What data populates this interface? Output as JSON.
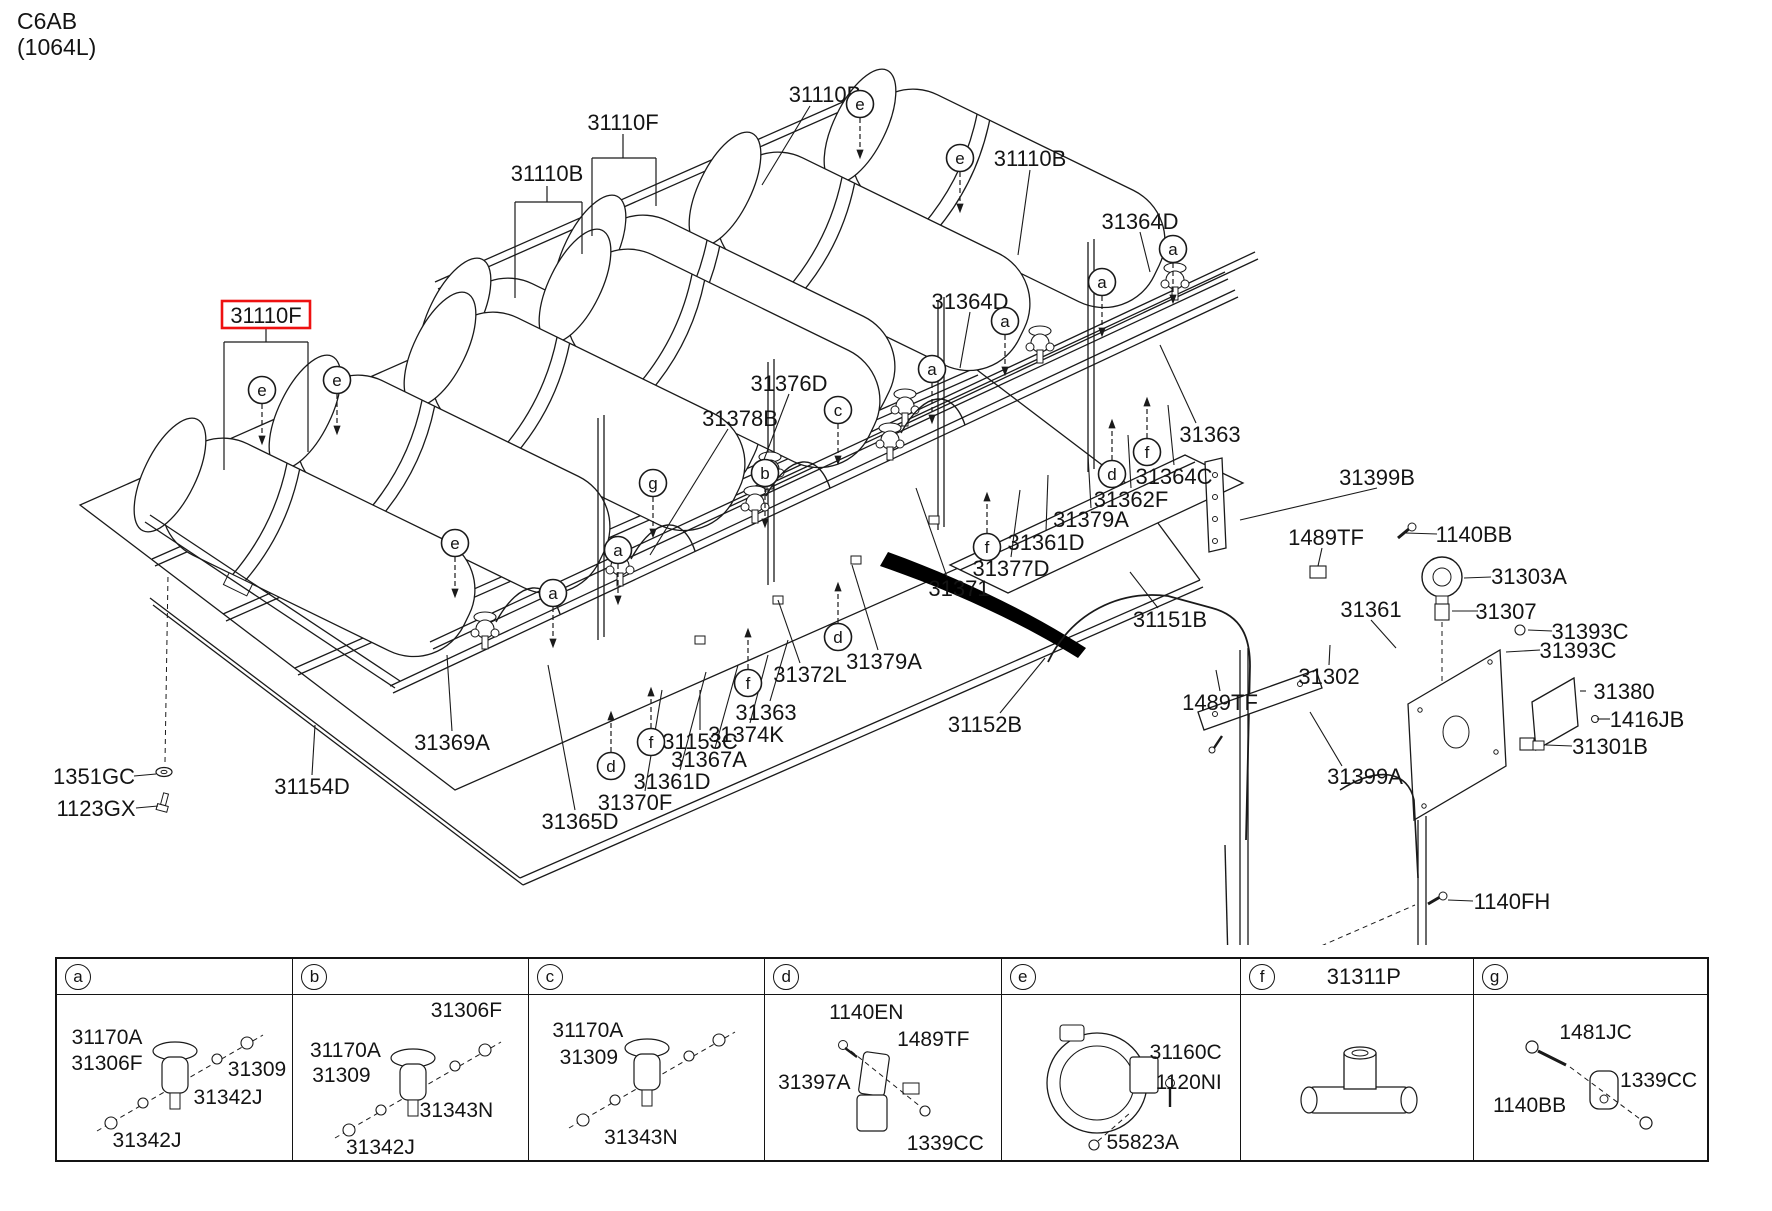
{
  "header": {
    "code": "C6AB",
    "capacity": "(1064L)"
  },
  "diagram": {
    "highlight_color": "#ee1111",
    "highlight": {
      "text": "31110F",
      "x": 266,
      "y": 315
    },
    "labels": [
      {
        "t": "31110B",
        "x": 825,
        "y": 94,
        "lead": [
          810,
          106,
          762,
          185
        ]
      },
      {
        "t": "31110F",
        "x": 623,
        "y": 122
      },
      {
        "t": "31110B",
        "x": 547,
        "y": 173
      },
      {
        "t": "31110B",
        "x": 1030,
        "y": 158,
        "lead": [
          1030,
          170,
          1018,
          255
        ]
      },
      {
        "t": "31364D",
        "x": 1140,
        "y": 221,
        "lead": [
          1140,
          232,
          1150,
          272
        ]
      },
      {
        "t": "31364D",
        "x": 970,
        "y": 301,
        "lead": [
          970,
          312,
          960,
          368
        ]
      },
      {
        "t": "31376D",
        "x": 789,
        "y": 383,
        "lead": [
          789,
          394,
          760,
          470
        ]
      },
      {
        "t": "31378B",
        "x": 740,
        "y": 418,
        "lead": [
          728,
          429,
          650,
          555
        ]
      },
      {
        "t": "31363",
        "x": 1210,
        "y": 434,
        "lead": [
          1196,
          423,
          1160,
          345
        ]
      },
      {
        "t": "31364C",
        "x": 1174,
        "y": 476,
        "lead": [
          1174,
          465,
          1168,
          405
        ]
      },
      {
        "t": "31362F",
        "x": 1131,
        "y": 499,
        "lead": [
          1131,
          488,
          1128,
          435
        ]
      },
      {
        "t": "31379A",
        "x": 1091,
        "y": 519,
        "lead": [
          1091,
          508,
          1088,
          455
        ]
      },
      {
        "t": "31361D",
        "x": 1046,
        "y": 542,
        "lead": [
          1046,
          531,
          1048,
          475
        ]
      },
      {
        "t": "31377D",
        "x": 1011,
        "y": 568,
        "lead": [
          1011,
          557,
          1020,
          490
        ]
      },
      {
        "t": "31371",
        "x": 959,
        "y": 588,
        "lead": [
          947,
          577,
          916,
          488
        ]
      },
      {
        "t": "31151B",
        "x": 1170,
        "y": 619,
        "lead": [
          1158,
          608,
          1130,
          572
        ]
      },
      {
        "t": "31399B",
        "x": 1377,
        "y": 477,
        "lead": [
          1377,
          488,
          1240,
          520
        ]
      },
      {
        "t": "1489TF",
        "x": 1326,
        "y": 537,
        "lead": [
          1322,
          548,
          1318,
          566
        ]
      },
      {
        "t": "1140BB",
        "x": 1474,
        "y": 534,
        "lead": [
          1437,
          534,
          1406,
          533
        ]
      },
      {
        "t": "31303A",
        "x": 1529,
        "y": 576,
        "lead": [
          1491,
          577,
          1464,
          578
        ]
      },
      {
        "t": "31307",
        "x": 1506,
        "y": 611,
        "lead": [
          1478,
          611,
          1452,
          611
        ]
      },
      {
        "t": "31361",
        "x": 1371,
        "y": 609,
        "lead": [
          1371,
          620,
          1396,
          648
        ]
      },
      {
        "t": "31393C",
        "x": 1590,
        "y": 631,
        "lead": [
          1552,
          631,
          1528,
          630
        ]
      },
      {
        "t": "31393C",
        "x": 1578,
        "y": 650,
        "lead": [
          1540,
          650,
          1506,
          652
        ]
      },
      {
        "t": "31302",
        "x": 1329,
        "y": 676,
        "lead": [
          1329,
          665,
          1330,
          645
        ]
      },
      {
        "t": "31380",
        "x": 1624,
        "y": 691,
        "lead": [
          1586,
          691,
          1580,
          691
        ]
      },
      {
        "t": "1416JB",
        "x": 1647,
        "y": 719,
        "lead": [
          1610,
          719,
          1597,
          719
        ]
      },
      {
        "t": "31301B",
        "x": 1610,
        "y": 746,
        "lead": [
          1572,
          746,
          1546,
          745
        ]
      },
      {
        "t": "1489TF",
        "x": 1220,
        "y": 702,
        "lead": [
          1220,
          691,
          1216,
          670
        ]
      },
      {
        "t": "31399A",
        "x": 1365,
        "y": 776,
        "lead": [
          1342,
          766,
          1310,
          712
        ]
      },
      {
        "t": "1140FH",
        "x": 1512,
        "y": 901,
        "lead": [
          1473,
          901,
          1448,
          900
        ]
      },
      {
        "t": "31379A",
        "x": 884,
        "y": 661,
        "lead": [
          878,
          650,
          852,
          565
        ]
      },
      {
        "t": "31372L",
        "x": 810,
        "y": 674,
        "lead": [
          800,
          663,
          778,
          600
        ]
      },
      {
        "t": "31363",
        "x": 766,
        "y": 712,
        "lead": [
          770,
          701,
          788,
          640
        ]
      },
      {
        "t": "31374K",
        "x": 746,
        "y": 734,
        "lead": [
          750,
          723,
          768,
          655
        ]
      },
      {
        "t": "31367A",
        "x": 709,
        "y": 759,
        "lead": [
          715,
          748,
          738,
          665
        ]
      },
      {
        "t": "31361D",
        "x": 672,
        "y": 781,
        "lead": [
          680,
          770,
          706,
          672
        ]
      },
      {
        "t": "31370F",
        "x": 635,
        "y": 802,
        "lead": [
          645,
          791,
          662,
          690
        ]
      },
      {
        "t": "31365D",
        "x": 580,
        "y": 821,
        "lead": [
          575,
          810,
          548,
          665
        ]
      },
      {
        "t": "31369A",
        "x": 452,
        "y": 742,
        "lead": [
          452,
          731,
          447,
          655
        ]
      },
      {
        "t": "31153C",
        "x": 700,
        "y": 741,
        "lead": [
          700,
          730,
          700,
          690
        ]
      },
      {
        "t": "31152B",
        "x": 985,
        "y": 724,
        "lead": [
          1000,
          713,
          1045,
          658
        ]
      },
      {
        "t": "31154D",
        "x": 312,
        "y": 786,
        "lead": [
          312,
          775,
          315,
          725
        ]
      },
      {
        "t": "1351GC",
        "x": 94,
        "y": 776,
        "lead": [
          134,
          776,
          156,
          774
        ]
      },
      {
        "t": "1123GX",
        "x": 96,
        "y": 808,
        "lead": [
          136,
          808,
          158,
          806
        ]
      }
    ],
    "callouts": [
      {
        "l": "e",
        "x": 860,
        "y": 104,
        "dir": "down"
      },
      {
        "l": "e",
        "x": 960,
        "y": 158,
        "dir": "down"
      },
      {
        "l": "e",
        "x": 262,
        "y": 390,
        "dir": "down"
      },
      {
        "l": "e",
        "x": 337,
        "y": 380,
        "dir": "down"
      },
      {
        "l": "e",
        "x": 455,
        "y": 543,
        "dir": "down"
      },
      {
        "l": "a",
        "x": 1173,
        "y": 249,
        "dir": "down"
      },
      {
        "l": "a",
        "x": 1102,
        "y": 282,
        "dir": "down"
      },
      {
        "l": "a",
        "x": 1005,
        "y": 321,
        "dir": "down"
      },
      {
        "l": "a",
        "x": 932,
        "y": 369,
        "dir": "down"
      },
      {
        "l": "a",
        "x": 618,
        "y": 550,
        "dir": "down"
      },
      {
        "l": "a",
        "x": 553,
        "y": 593,
        "dir": "down"
      },
      {
        "l": "c",
        "x": 838,
        "y": 410,
        "dir": "down"
      },
      {
        "l": "b",
        "x": 765,
        "y": 473,
        "dir": "down"
      },
      {
        "l": "g",
        "x": 653,
        "y": 483,
        "dir": "down"
      },
      {
        "l": "f",
        "x": 1147,
        "y": 452,
        "dir": "up"
      },
      {
        "l": "f",
        "x": 987,
        "y": 547,
        "dir": "up"
      },
      {
        "l": "f",
        "x": 748,
        "y": 683,
        "dir": "up"
      },
      {
        "l": "f",
        "x": 651,
        "y": 742,
        "dir": "up"
      },
      {
        "l": "d",
        "x": 1112,
        "y": 474,
        "dir": "up"
      },
      {
        "l": "d",
        "x": 838,
        "y": 637,
        "dir": "up"
      },
      {
        "l": "d",
        "x": 611,
        "y": 766,
        "dir": "up"
      }
    ]
  },
  "panel_table": {
    "columns": [
      {
        "letter": "a",
        "code": "",
        "labels": [
          {
            "t": "31170A",
            "x": 50,
            "y": 43
          },
          {
            "t": "31306F",
            "x": 50,
            "y": 69
          },
          {
            "t": "31309",
            "x": 200,
            "y": 75
          },
          {
            "t": "31342J",
            "x": 171,
            "y": 103
          },
          {
            "t": "31342J",
            "x": 90,
            "y": 146
          }
        ]
      },
      {
        "letter": "b",
        "code": "",
        "labels": [
          {
            "t": "31170A",
            "x": 52,
            "y": 56
          },
          {
            "t": "31309",
            "x": 48,
            "y": 81
          },
          {
            "t": "31306F",
            "x": 173,
            "y": 16
          },
          {
            "t": "31343N",
            "x": 163,
            "y": 116
          },
          {
            "t": "31342J",
            "x": 87,
            "y": 153
          }
        ]
      },
      {
        "letter": "c",
        "code": "",
        "labels": [
          {
            "t": "31170A",
            "x": 59,
            "y": 36
          },
          {
            "t": "31309",
            "x": 60,
            "y": 63
          },
          {
            "t": "31343N",
            "x": 112,
            "y": 143
          }
        ]
      },
      {
        "letter": "d",
        "code": "",
        "labels": [
          {
            "t": "1140EN",
            "x": 101,
            "y": 18
          },
          {
            "t": "1489TF",
            "x": 168,
            "y": 45
          },
          {
            "t": "31397A",
            "x": 49,
            "y": 88
          },
          {
            "t": "1339CC",
            "x": 180,
            "y": 149
          }
        ]
      },
      {
        "letter": "e",
        "code": "",
        "labels": [
          {
            "t": "31160C",
            "x": 184,
            "y": 58
          },
          {
            "t": "1120NI",
            "x": 187,
            "y": 88
          },
          {
            "t": "55823A",
            "x": 141,
            "y": 148
          }
        ]
      },
      {
        "letter": "f",
        "code": "31311P",
        "labels": []
      },
      {
        "letter": "g",
        "code": "",
        "labels": [
          {
            "t": "1481JC",
            "x": 122,
            "y": 38
          },
          {
            "t": "1339CC",
            "x": 185,
            "y": 86
          },
          {
            "t": "1140BB",
            "x": 56,
            "y": 111
          }
        ]
      }
    ]
  }
}
